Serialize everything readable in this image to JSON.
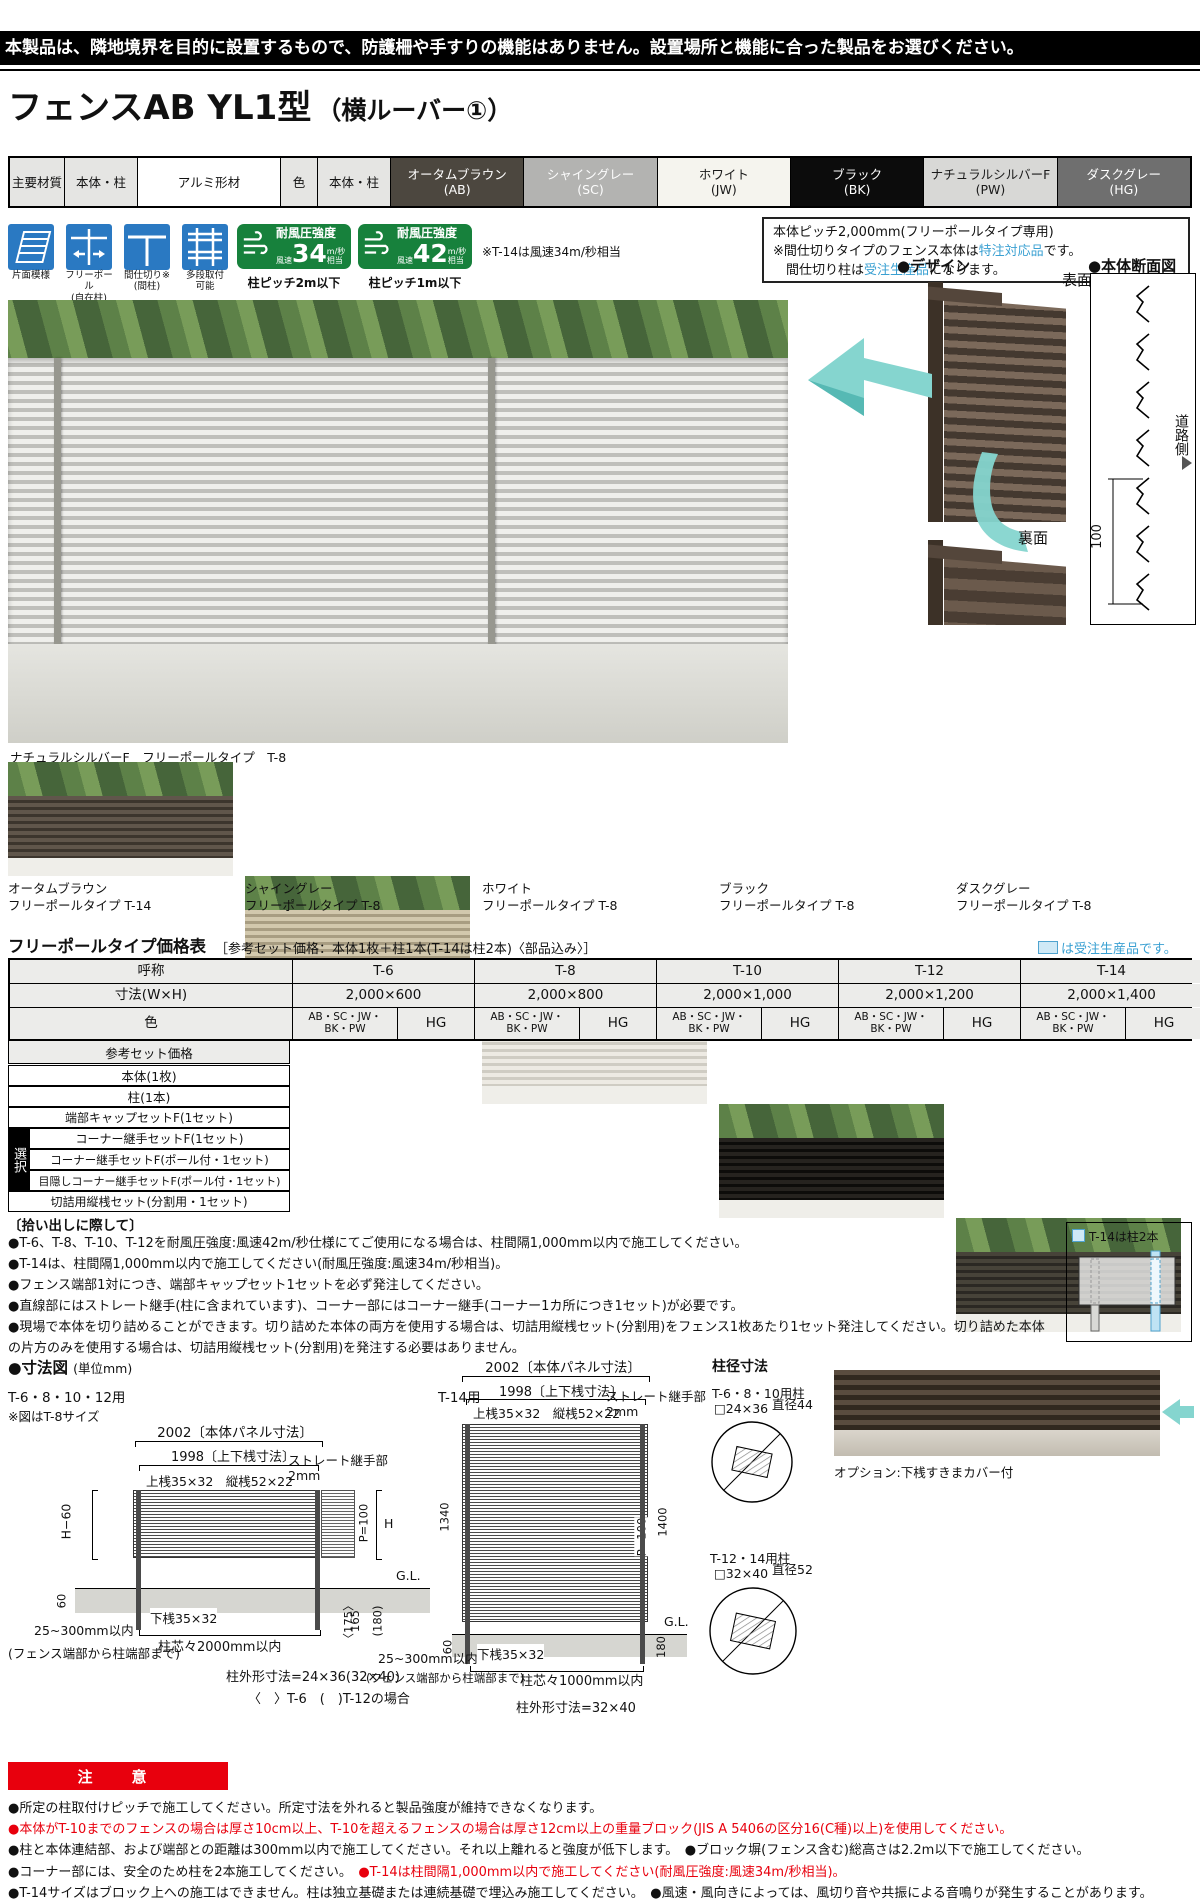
{
  "notice_bar": "本製品は、隣地境界を目的に設置するもので、防護柵や手すりの機能はありません。設置場所と機能に合った製品をお選びください。",
  "title": {
    "main": "フェンスAB YL1型",
    "sub": "（横ルーバー①）"
  },
  "spec": {
    "material_label": "主要材質",
    "scope1": "本体・柱",
    "material": "アルミ形材",
    "color_label": "色",
    "scope2": "本体・柱",
    "colors": [
      {
        "name": "オータムブラウン",
        "code": "(AB)",
        "style": "background:#4c473f;color:#fff"
      },
      {
        "name": "シャイングレー",
        "code": "(SC)",
        "style": "background:#b3b3b1;color:#fdfdfd"
      },
      {
        "name": "ホワイト",
        "code": "(JW)",
        "style": "background:#f5f4ee;color:#1a1a1a"
      },
      {
        "name": "ブラック",
        "code": "(BK)",
        "style": "background:#0c0c0c;color:#fff"
      },
      {
        "name": "ナチュラルシルバーF",
        "code": "(PW)",
        "style": "background:#d8d8d6;color:#1a1a1a"
      },
      {
        "name": "ダスクグレー",
        "code": "(HG)",
        "style": "background:#6f6f6f;color:#fff"
      }
    ]
  },
  "features": [
    {
      "label": "片面模様",
      "sub": ""
    },
    {
      "label": "フリーポール",
      "sub": "(自在柱)"
    },
    {
      "label": "間仕切り※",
      "sub": "(間柱)"
    },
    {
      "label": "多段取付",
      "sub": "可能"
    }
  ],
  "wind": {
    "badges": [
      {
        "title": "耐風圧強度",
        "speed_label": "風速",
        "value": "34",
        "unit": "m/秒",
        "equiv": "相当",
        "note": "柱ピッチ2m以下"
      },
      {
        "title": "耐風圧強度",
        "speed_label": "風速",
        "value": "42",
        "unit": "m/秒",
        "equiv": "相当",
        "note": "柱ピッチ1m以下"
      }
    ],
    "footnote": "※T-14は風速34m/秒相当"
  },
  "pitch_box": {
    "line1": "本体ピッチ2,000mm(フリーポールタイプ専用)",
    "line2a": "※間仕切りタイプのフェンス本体は",
    "line2b": "特注対応品",
    "line2c": "です。",
    "line3a": "　間仕切り柱は",
    "line3b": "受注生産品",
    "line3c": "になります。"
  },
  "design": {
    "heading": "●デザイン",
    "front": "表面",
    "back": "裏面"
  },
  "section_fig": {
    "heading": "●本体断面図",
    "road": "道路側",
    "dim": "100"
  },
  "main_photo": {
    "caption": "ナチュラルシルバーF　フリーポールタイプ　T-8"
  },
  "swatches": [
    {
      "name": "オータムブラウン",
      "type": "フリーポールタイプ T-14",
      "fence_style": "background:repeating-linear-gradient(180deg,#60564b 0 4px,#3c352d 4px 7px)"
    },
    {
      "name": "シャイングレー",
      "type": "フリーポールタイプ T-8",
      "fence_style": "background:repeating-linear-gradient(180deg,#d2c8ad 0 4px,#a89d82 4px 7px)"
    },
    {
      "name": "ホワイト",
      "type": "フリーポールタイプ T-8",
      "fence_style": "background:repeating-linear-gradient(180deg,#edeae3 0 4px,#cfccc3 4px 7px)"
    },
    {
      "name": "ブラック",
      "type": "フリーポールタイプ T-8",
      "fence_style": "background:repeating-linear-gradient(180deg,#26231f 0 4px,#0d0c0a 4px 7px)"
    },
    {
      "name": "ダスクグレー",
      "type": "フリーポールタイプ T-8",
      "fence_style": "background:repeating-linear-gradient(180deg,#474339 0 4px,#2b2823 4px 7px)"
    }
  ],
  "price_table": {
    "title": "フリーポールタイプ価格表",
    "subtitle": "［参考セット価格：本体1枚＋柱1本(T-14は柱2本)〈部品込み〉］",
    "legend": "は受注生産品です。",
    "name_label": "呼称",
    "size_label": "寸法(W×H)",
    "color_label": "色",
    "columns": [
      {
        "name": "T-6",
        "size": "2,000×600"
      },
      {
        "name": "T-8",
        "size": "2,000×800"
      },
      {
        "name": "T-10",
        "size": "2,000×1,000"
      },
      {
        "name": "T-12",
        "size": "2,000×1,200"
      },
      {
        "name": "T-14",
        "size": "2,000×1,400"
      }
    ],
    "color_a1": "AB・SC・JW・",
    "color_a2": "BK・PW",
    "color_b": "HG",
    "rows": [
      "参考セット価格",
      "本体(1枚)",
      "柱(1本)",
      "端部キャップセットF(1セット)",
      "コーナー継手セットF(1セット)",
      "コーナー継手セットF(ポール付・1セット)",
      "目隠しコーナー継手セットF(ポール付・1セット)",
      "切詰用縦桟セット(分割用・1セット)"
    ],
    "select_label": "選択"
  },
  "pickup": {
    "heading": "〔拾い出しに際して〕",
    "items": [
      "●T-6、T-8、T-10、T-12を耐風圧強度:風速42m/秒仕様にてご使用になる場合は、柱間隔1,000mm以内で施工してください。",
      "●T-14は、柱間隔1,000mm以内で施工してください(耐風圧強度:風速34m/秒相当)。",
      "●フェンス端部1対につき、端部キャップセット1セットを必ず発注してください。",
      "●直線部にはストレート継手(柱に含まれています)、コーナー部にはコーナー継手(コーナー1カ所につき1セット)が必要です。",
      "●現場で本体を切り詰めることができます。切り詰めた本体の両方を使用する場合は、切詰用縦桟セット(分割用)をフェンス1枚あたり1セット発注してください。切り詰めた本体の片方のみを使用する場合は、切詰用縦桟セット(分割用)を発注する必要はありません。"
    ]
  },
  "t14_box": {
    "label": "T-14は柱2本"
  },
  "dims": {
    "heading": "●寸法図",
    "unit": "(単位mm)",
    "left": {
      "usage": "T-6・8・10・12用",
      "note": "※図はT-8サイズ",
      "panel": "2002〔本体パネル寸法〕",
      "rails": "1998〔上下桟寸法〕",
      "top_rail": "上桟35×32　縦桟52×22",
      "joint": "ストレート継手部",
      "joint_gap": "2mm",
      "h60": "H−60",
      "p100": "P=100",
      "h": "H",
      "gl": "G.L.",
      "n60": "60",
      "bottom_rail": "下桟35×32",
      "pitch": "柱芯々2000mm以内",
      "edge": "25~300mm以内",
      "edge_note": "(フェンス端部から柱端部まで)",
      "d175": "〈175〉",
      "d165": "165",
      "d180": "(180)",
      "post_dim": "柱外形寸法=24×36(32×40)",
      "post_dim2": "〈　〉T-6　(　)T-12の場合"
    },
    "mid": {
      "usage": "T-14用",
      "panel": "2002〔本体パネル寸法〕",
      "rails": "1998〔上下桟寸法〕",
      "top_rail": "上桟35×32　縦桟52×22",
      "joint": "ストレート継手部",
      "joint_gap": "2mm",
      "v1340": "1340",
      "v1400": "1400",
      "p100": "P=100",
      "gl": "G.L.",
      "n60": "60",
      "n180": "180",
      "bottom_rail": "下桟35×32",
      "pitch": "柱芯々1000mm以内",
      "edge": "25~300mm以内",
      "edge_note": "(フェンス端部から柱端部まで)",
      "post_dim": "柱外形寸法=32×40"
    },
    "posts": {
      "heading": "柱径寸法",
      "p1": "T-6・8・10用柱",
      "p1_size": "□24×36",
      "p1_dia": "直径44",
      "p2": "T-12・14用柱",
      "p2_size": "□32×40",
      "p2_dia": "直径52"
    },
    "option": "オプション:下桟すきまカバー付"
  },
  "caution": {
    "label": "注　意",
    "lines": [
      {
        "black": "●所定の柱取付けピッチで施工してください。所定寸法を外れると製品強度が維持できなくなります。",
        "red": ""
      },
      {
        "black": "",
        "red": "●本体がT-10までのフェンスの場合は厚さ10cm以上、T-10を超えるフェンスの場合は厚さ12cm以上の重量ブロック(JIS A 5406の区分16(C種)以上)を使用してください。"
      },
      {
        "black": "●柱と本体連結部、および端部との距離は300mm以内で施工してください。それ以上離れると強度が低下します。　●ブロック塀(フェンス含む)総高さは2.2m以下で施工してください。",
        "red": ""
      },
      {
        "black": "●コーナー部には、安全のため柱を2本施工してください。　",
        "red": "●T-14は柱間隔1,000mm以内で施工してください(耐風圧強度:風速34m/秒相当)。"
      },
      {
        "black": "●T-14サイズはブロック上への施工はできません。柱は独立基礎または連続基礎で埋込み施工してください。　●風速・風向きによっては、風切り音や共振による音鳴りが発生することがあります。",
        "red": ""
      }
    ]
  }
}
